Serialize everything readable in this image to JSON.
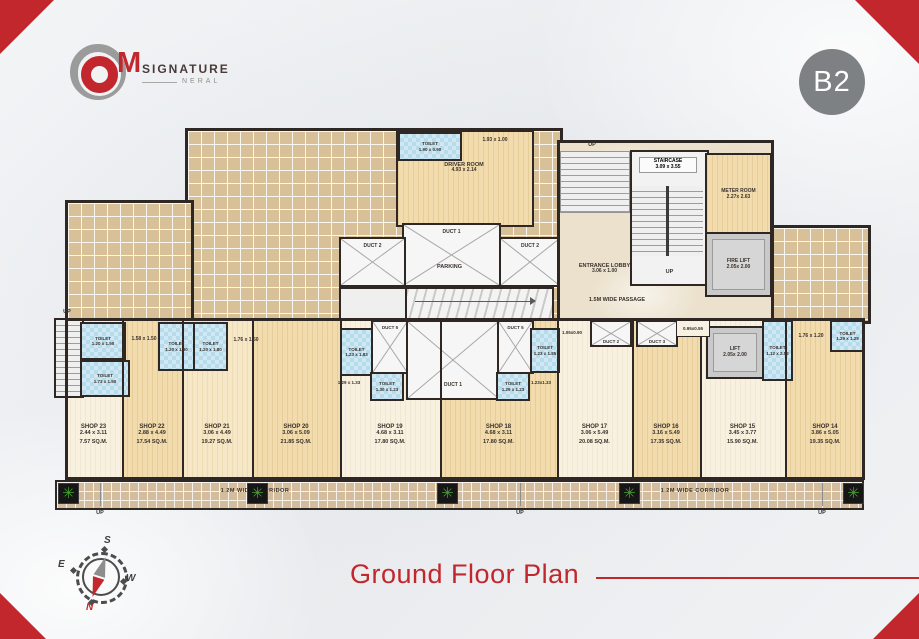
{
  "header": {
    "badge": "B2",
    "logo": {
      "m": "M",
      "signature": "SIGNATURE",
      "neral": "NERAL"
    }
  },
  "footer": {
    "title": "Ground Floor Plan"
  },
  "compass": {
    "n": "N",
    "s": "S",
    "e": "E",
    "w": "W"
  },
  "colors": {
    "accent_red": "#c1272d",
    "badge_gray": "#7e8184",
    "wall_dark": "#2e2724"
  },
  "plan": {
    "upper": {
      "up_top": "UP",
      "toilet_driver": {
        "label": "TOILET",
        "dims": "1.90 x 0.90"
      },
      "open_area_dims": "1.93 x 1.00",
      "driver_room": {
        "label": "DRIVER ROOM",
        "dims": "4.93 x 2.14"
      },
      "duct1": "DUCT 1",
      "duct2_left": "DUCT 2",
      "duct2_right": "DUCT 2",
      "parking": "PARKING",
      "staircase": {
        "label": "STAIRCASE",
        "dims": "3.09 x 3.55",
        "up": "UP"
      },
      "meter_room": {
        "label": "METER ROOM",
        "dims": "2.27x 2.63"
      },
      "fire_lift": {
        "label": "FIRE LIFT",
        "dims": "2.05x 2.00"
      },
      "entrance_lobby": {
        "label": "ENTRANCE LOBBY",
        "dims": "3.06 x 1.00"
      },
      "passage": "1.5M WIDE PASSAGE"
    },
    "mid": {
      "up_left": "UP",
      "toilets": [
        {
          "label": "TOILET",
          "dims": "1.20 x 1.50"
        },
        {
          "label": "TOILET",
          "dims": "1.73 x 1.50"
        },
        {
          "label": "TOILET",
          "dims": "1.20 x 1.80"
        },
        {
          "label": "TOILET",
          "dims": "1.20 x 1.80"
        },
        {
          "label": "TOILET",
          "dims": "1.23 x 1.83"
        },
        {
          "label": "TOILET",
          "dims": "1.30 x 1.23"
        },
        {
          "label": "TOILET",
          "dims": "1.29 x 1.23"
        },
        {
          "label": "TOILET",
          "dims": "1.23 x 1.85"
        },
        {
          "label": "TOILET",
          "dims": "1.12 x 2.52"
        },
        {
          "label": "TOILET",
          "dims": "1.29 x 1.29"
        }
      ],
      "open_labels": [
        "1.58 x 1.50",
        "1.76 x 1.50",
        "1.29 x 1.33",
        "1.23x1.33",
        "1.05x0.90",
        "0.95x0.55",
        "1.76 x 1.20"
      ],
      "duct5_left": "DUCT 5",
      "duct5_right": "DUCT 5",
      "duct1": "DUCT 1",
      "duct2": "DUCT 2",
      "duct3": "DUCT 3",
      "lift": {
        "label": "LIFT",
        "dims": "2.05x 2.00"
      }
    },
    "shops": [
      {
        "name": "SHOP 23",
        "dims": "2.44 x 3.11",
        "area": "7.57 SQ.M."
      },
      {
        "name": "SHOP 22",
        "dims": "2.88 x 4.49",
        "area": "17.54 SQ.M."
      },
      {
        "name": "SHOP 21",
        "dims": "3.06 x 4.49",
        "area": "19.27 SQ.M."
      },
      {
        "name": "SHOP 20",
        "dims": "3.06 x 5.09",
        "area": "21.85 SQ.M."
      },
      {
        "name": "SHOP 19",
        "dims": "4.68 x 3.11",
        "area": "17.80 SQ.M."
      },
      {
        "name": "SHOP 18",
        "dims": "4.68 x 3.11",
        "area": "17.80 SQ.M."
      },
      {
        "name": "SHOP 17",
        "dims": "3.06 x 5.49",
        "area": "20.08 SQ.M."
      },
      {
        "name": "SHOP 16",
        "dims": "3.16 x 5.49",
        "area": "17.35 SQ.M."
      },
      {
        "name": "SHOP 15",
        "dims": "3.45 x 3.77",
        "area": "15.90 SQ.M."
      },
      {
        "name": "SHOP 14",
        "dims": "3.86 x 5.05",
        "area": "19.35 SQ.M."
      }
    ],
    "corridor": {
      "left_label": "1.2M WIDE CORRIDOR",
      "right_label": "1.2M WIDE CORRIDOR",
      "up1": "UP",
      "up2": "UP",
      "up3": "UP"
    }
  }
}
